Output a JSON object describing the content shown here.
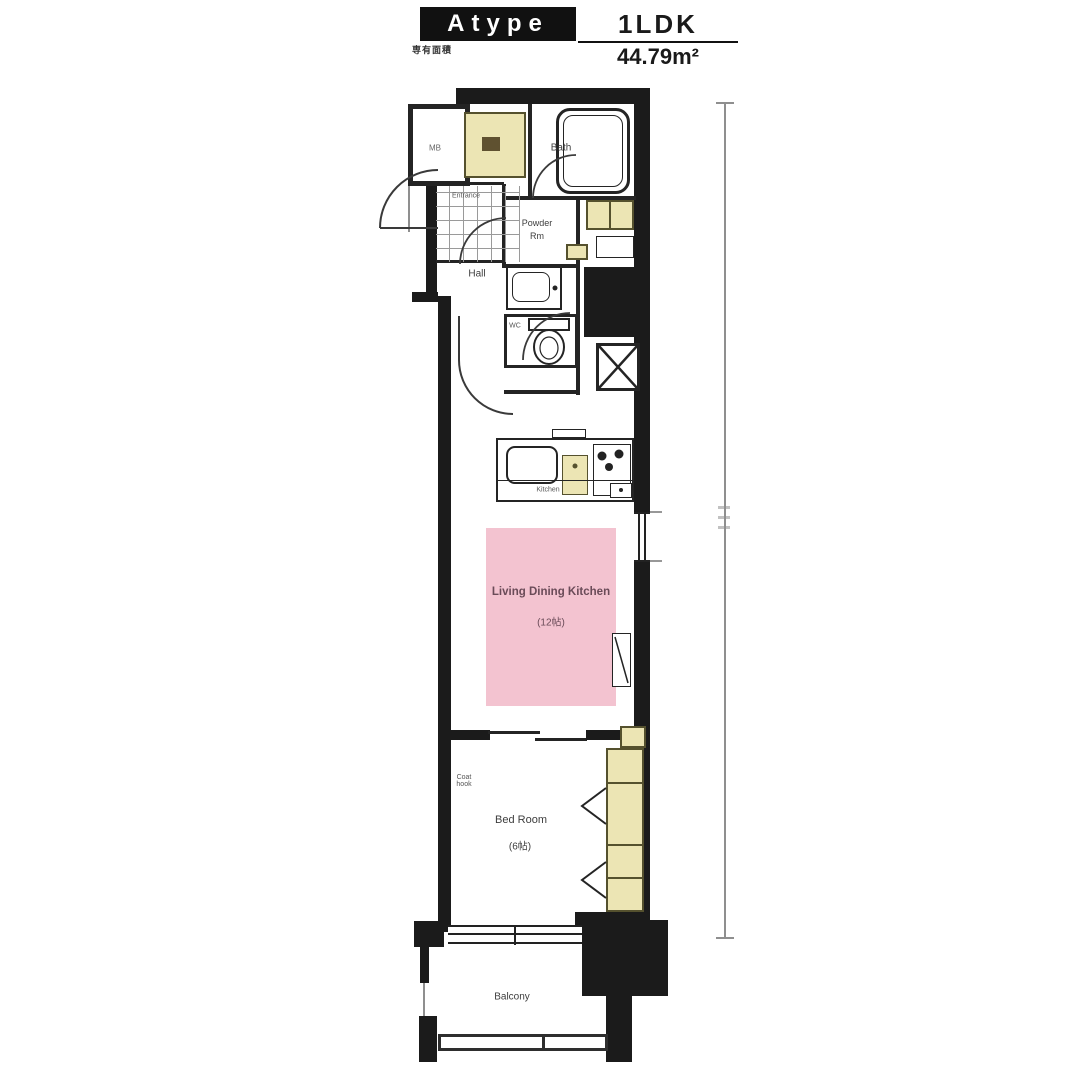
{
  "header": {
    "type_label": "Atype",
    "layout_label": "1LDK",
    "area_label": "44.79m²",
    "note_label": "専有面積"
  },
  "labels": {
    "bath": "Bath",
    "powder_line1": "Powder",
    "powder_line2": "Rm",
    "hall": "Hall",
    "entrance": "Entrance",
    "meter_box": "MB",
    "wc": "WC",
    "kitchen": "Kitchen",
    "ldk_line1": "Living Dining Kitchen",
    "ldk_line2": "(12帖)",
    "bedroom_line1": "Bed Room",
    "bedroom_line2": "(6帖)",
    "coat_hook_line1": "Coat",
    "coat_hook_line2": "hook",
    "balcony": "Balcony"
  },
  "colors": {
    "wall": "#1b1b1b",
    "fixture_yellow": "#ece5b4",
    "ldk_pink": "#f3c3d0"
  }
}
